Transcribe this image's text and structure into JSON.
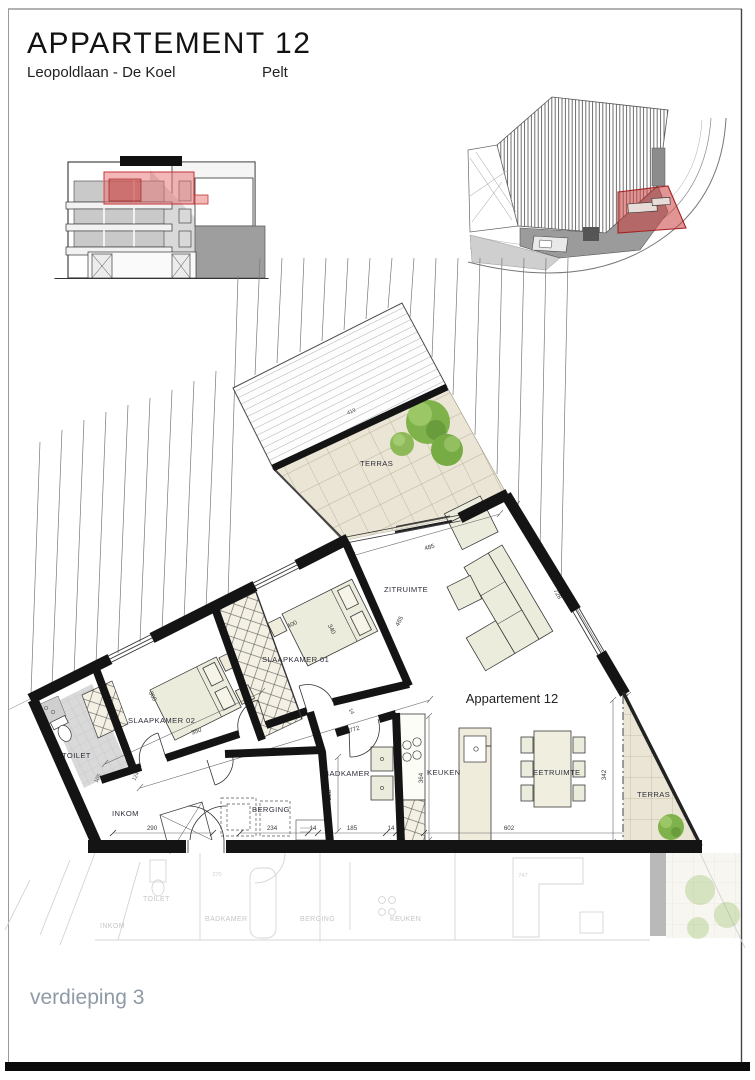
{
  "sheet": {
    "title": "APPARTEMENT 12",
    "street": "Leopoldlaan - De Koel",
    "city": "Pelt",
    "floor_label": "verdieping 3"
  },
  "floor_plan": {
    "apartment_label": "Appartement 12",
    "rooms": {
      "terras_top": "TERRAS",
      "zitruimte": "ZITRUIMTE",
      "slaapkamer01": "SLAAPKAMER 01",
      "slaapkamer02": "SLAAPKAMER 02",
      "toilet": "TOILET",
      "inkom": "INKOM",
      "berging": "BERGING",
      "badkamer": "BADKAMER",
      "keuken": "KEUKEN",
      "eetruimte": "EETRUIMTE",
      "terras_right": "TERRAS"
    },
    "dimensions": {
      "canopy": "419",
      "zitruimte_width": "485",
      "zitruimte_depth": "465",
      "right_wall": "728",
      "bed1_width": "400",
      "bed1_depth": "340",
      "bed2_width": "360",
      "slaapkamer2_width": "350",
      "hall_length": "772",
      "inkom_width": "290",
      "inkom_depth": "124",
      "toilet_width": "105",
      "berging_width": "234",
      "wall_small_a": "14",
      "badkamer_width": "185",
      "wall_small_b": "14",
      "wall_small_c": "14",
      "badkamer_depth": "228",
      "keuken_depth": "364",
      "eetruimte_width": "602",
      "terras_right_depth": "342"
    }
  },
  "ghost_plan": {
    "rooms": {
      "inkom": "INKOM",
      "toilet": "TOILET",
      "badkamer": "BADKAMER",
      "berging": "BERGING",
      "keuken": "KEUKEN"
    },
    "dimensions": {
      "a": "270",
      "b": "747"
    }
  },
  "colors": {
    "highlight": "#d86a6a",
    "walls": "#141414",
    "tree": "#7fb24a",
    "floor": "#eae5d4",
    "footer_text": "#8e9aa6"
  }
}
